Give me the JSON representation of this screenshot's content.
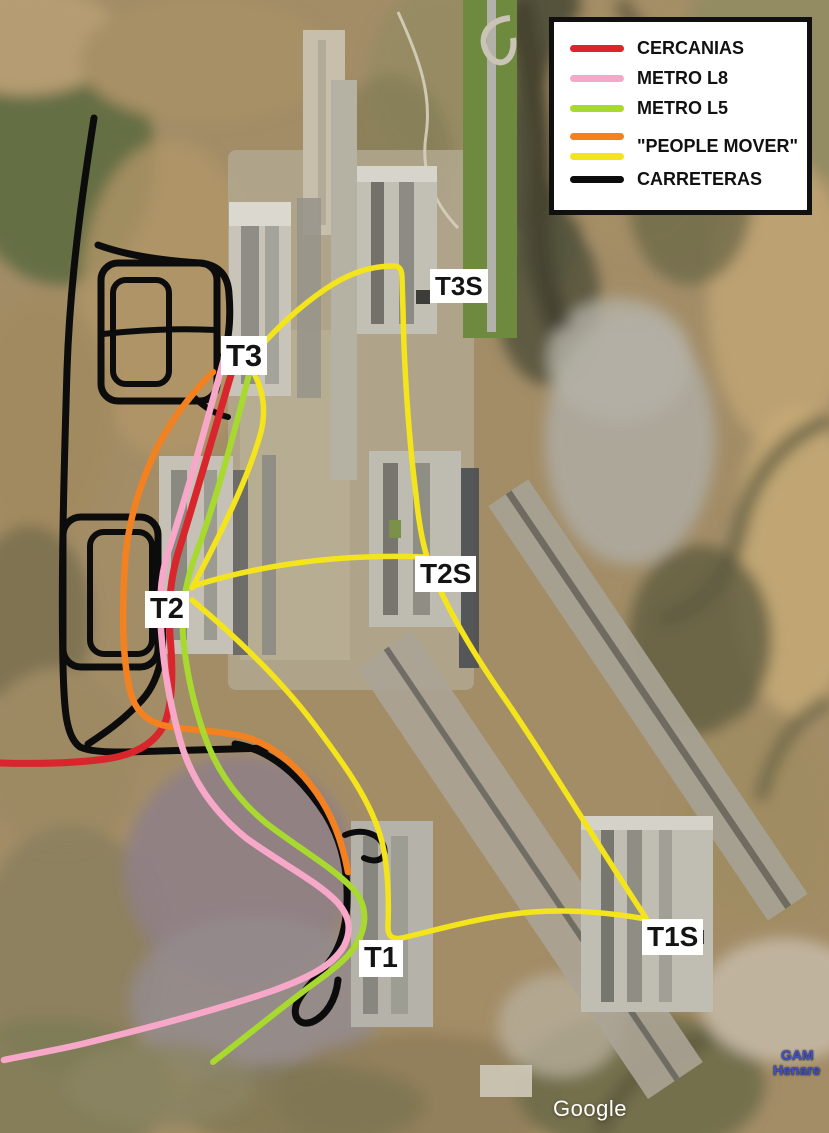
{
  "legend": {
    "items": [
      {
        "name": "cercanias",
        "label": "CERCANIAS",
        "colors": [
          "#d8262c"
        ]
      },
      {
        "name": "metro-l8",
        "label": "METRO L8",
        "colors": [
          "#f7a8c8"
        ]
      },
      {
        "name": "metro-l5",
        "label": "METRO L5",
        "colors": [
          "#a8d92f"
        ]
      },
      {
        "name": "people-mover",
        "label": "\"PEOPLE MOVER\"",
        "colors": [
          "#f48120",
          "#f4e41c"
        ]
      },
      {
        "name": "carreteras",
        "label": "CARRETERAS",
        "colors": [
          "#0c0c0c"
        ]
      }
    ]
  },
  "routes": {
    "cercanias": {
      "color": "#d8262c"
    },
    "metro_l8": {
      "color": "#f7a8c8"
    },
    "metro_l5": {
      "color": "#a8d92f"
    },
    "people_mover_yellow": {
      "color": "#f4e41c"
    },
    "people_mover_orange": {
      "color": "#f48120"
    },
    "carreteras": {
      "color": "#0c0c0c"
    }
  },
  "terminals": {
    "t3": "T3",
    "t3s": "T3S",
    "t2": "T2",
    "t2s": "T2S",
    "t1": "T1",
    "t1s": "T1S"
  },
  "watermark": "Google",
  "corner_place": {
    "line1": "GAM",
    "line2": "Henare"
  }
}
